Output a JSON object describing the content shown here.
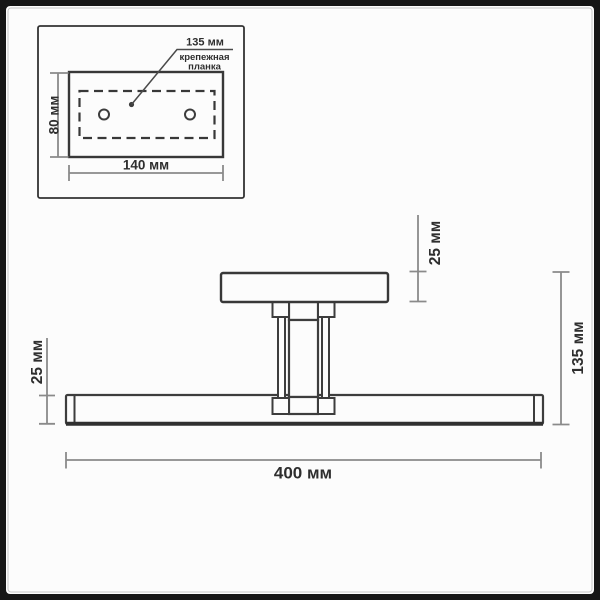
{
  "diagram": {
    "inset": {
      "hole_spacing": "135 мм",
      "plate_name_line1": "крепежная",
      "plate_name_line2": "планка",
      "plate_height": "80 мм",
      "plate_width": "140 мм"
    },
    "main": {
      "canopy_thickness": "25 мм",
      "bar_thickness": "25 мм",
      "overall_height": "135 мм",
      "overall_length": "400 мм"
    },
    "colors": {
      "outline": "#3d3d3d",
      "dimension_line": "#8a8a8a",
      "text": "#2e2e2e",
      "frame": "#151515",
      "background": "#fcfcfc"
    }
  }
}
